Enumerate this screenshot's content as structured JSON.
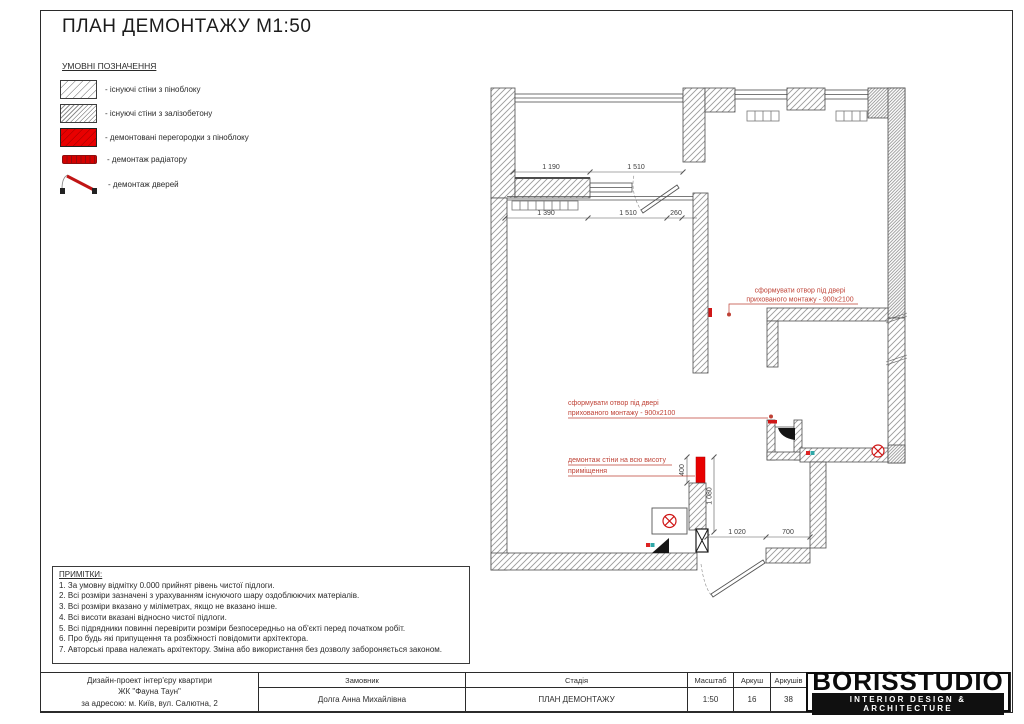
{
  "sheet": {
    "title": "ПЛАН ДЕМОНТАЖУ М1:50",
    "legend": {
      "header": "УМОВНІ ПОЗНАЧЕННЯ",
      "items": [
        {
          "label": "- існуючі стіни з піноблоку"
        },
        {
          "label": "- існуючі стіни з залізобетону"
        },
        {
          "label": "- демонтовані перегородки з піноблоку"
        },
        {
          "label": "- демонтаж радіатору"
        },
        {
          "label": "- демонтаж дверей"
        }
      ]
    },
    "notes": {
      "header": "ПРИМІТКИ:",
      "items": [
        "1. За умовну відмітку 0.000 прийнят рівень чистої підлоги.",
        "2. Всі розміри зазначені з урахуванням існуючого шару оздоблюючих матеріалів.",
        "3. Всі розміри вказано у міліметрах, якщо не вказано інше.",
        "4. Всі висоти вказані відносно чистої підлоги.",
        "5. Всі підрядники повинні перевірити розміри безпосередньо на об'єкті перед початком робіт.",
        "6. Про будь які припущення та розбіжності повідомити архітектора.",
        "7. Авторські права належать архітектору. Зміна або використання без дозволу забороняється законом."
      ]
    },
    "plan": {
      "dims": {
        "row1": [
          "1 190",
          "1 510"
        ],
        "row2": [
          "1 390",
          "1 510",
          "260"
        ],
        "v400": "400",
        "v1080": "1 080",
        "bottom": [
          "1 020",
          "700"
        ]
      },
      "annotations": {
        "opening1_l1": "сформувати отвор під двері",
        "opening1_l2": "прихованого монтажу - 900х2100",
        "opening2_l1": "сформувати отвор під двері",
        "opening2_l2": "прихованого монтажу - 900х2100",
        "demolish_l1": "демонтаж стіни на всю висоту",
        "demolish_l2": "приміщення"
      }
    },
    "titleblock": {
      "project_line1": "Дизайн-проект інтер'єру квартири",
      "project_line2": "ЖК \"Фауна Таун\"",
      "project_line3": "за адресою: м. Київ, вул. Салютна, 2",
      "client_label": "Замовник",
      "client_value": "Долга Анна Михайлівна",
      "stage_label": "Стадія",
      "stage_value": "ПЛАН ДЕМОНТАЖУ",
      "scale_label": "Масштаб",
      "scale_value": "1:50",
      "sheet_label": "Аркуш",
      "sheet_value": "16",
      "sheets_label": "Аркушів",
      "sheets_value": "38",
      "logo_name": "BORISSTUDIO",
      "logo_tagline": "INTERIOR DESIGN & ARCHITECTURE"
    },
    "colors": {
      "demolition_red": "#e80000",
      "annotation_red": "#bf4236",
      "wall_hatch": "#9b9b9b"
    }
  }
}
